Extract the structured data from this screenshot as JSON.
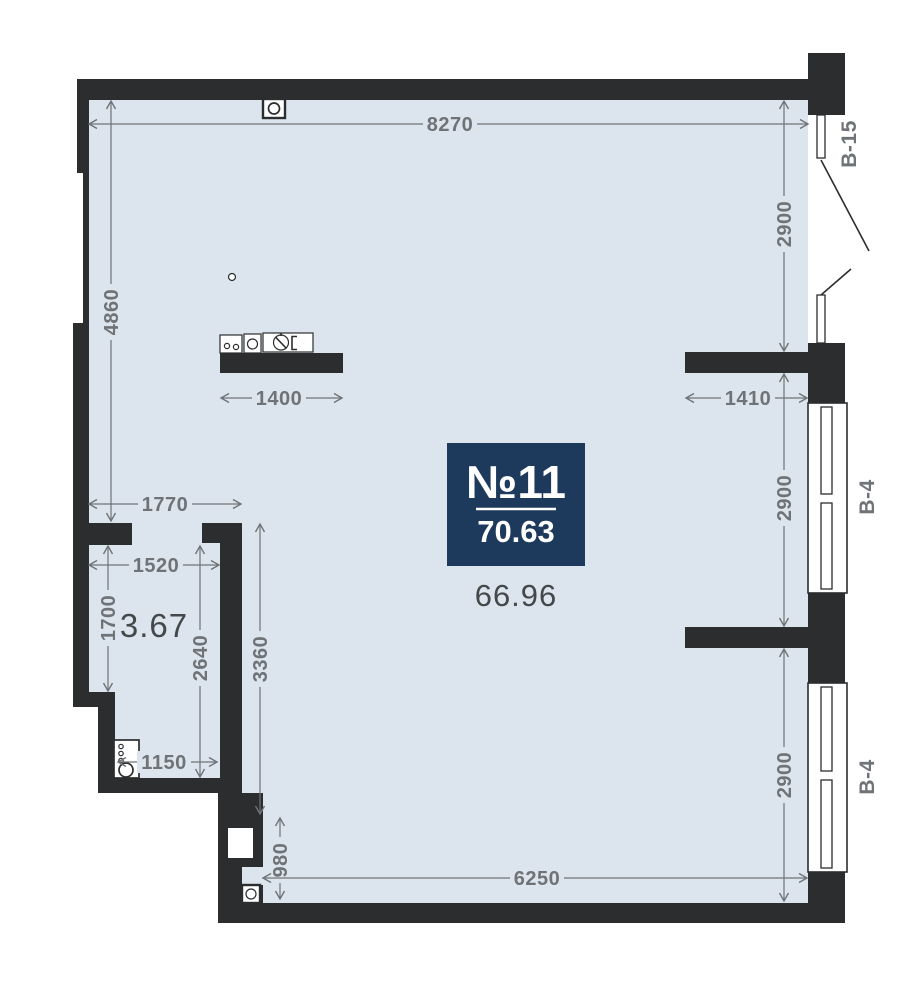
{
  "badge": {
    "unit_number": "№11",
    "total_area": "70.63"
  },
  "rooms": [
    {
      "id": "living-room",
      "area": "66.96"
    },
    {
      "id": "bathroom",
      "area": "3.67"
    }
  ],
  "window_labels": [
    {
      "id": "balcony-door",
      "label": "В-15"
    },
    {
      "id": "window-upper",
      "label": "В-4"
    },
    {
      "id": "window-lower",
      "label": "В-4"
    }
  ],
  "dimensions": [
    {
      "id": "top-width",
      "value": "8270"
    },
    {
      "id": "right-top-height",
      "value": "2900"
    },
    {
      "id": "left-height",
      "value": "4860"
    },
    {
      "id": "kitchen-counter-width",
      "value": "1400"
    },
    {
      "id": "right-pier-width",
      "value": "1410"
    },
    {
      "id": "right-middle-height",
      "value": "2900"
    },
    {
      "id": "right-bottom-height",
      "value": "2900"
    },
    {
      "id": "hall-width",
      "value": "1770"
    },
    {
      "id": "bathroom-width",
      "value": "1520"
    },
    {
      "id": "bathroom-left-height",
      "value": "1700"
    },
    {
      "id": "bathroom-inner-height",
      "value": "2640"
    },
    {
      "id": "lower-left-height",
      "value": "3360"
    },
    {
      "id": "bathroom-bottom-width",
      "value": "1150"
    },
    {
      "id": "bottom-step-height",
      "value": "980"
    },
    {
      "id": "bottom-width",
      "value": "6250"
    }
  ],
  "colors": {
    "wall": "#2b2d2e",
    "floor": "#dce5ee",
    "dim": "#6f7377",
    "badge": "#1d3a5c",
    "badgeText": "#ffffff",
    "areaText": "#45484a"
  }
}
